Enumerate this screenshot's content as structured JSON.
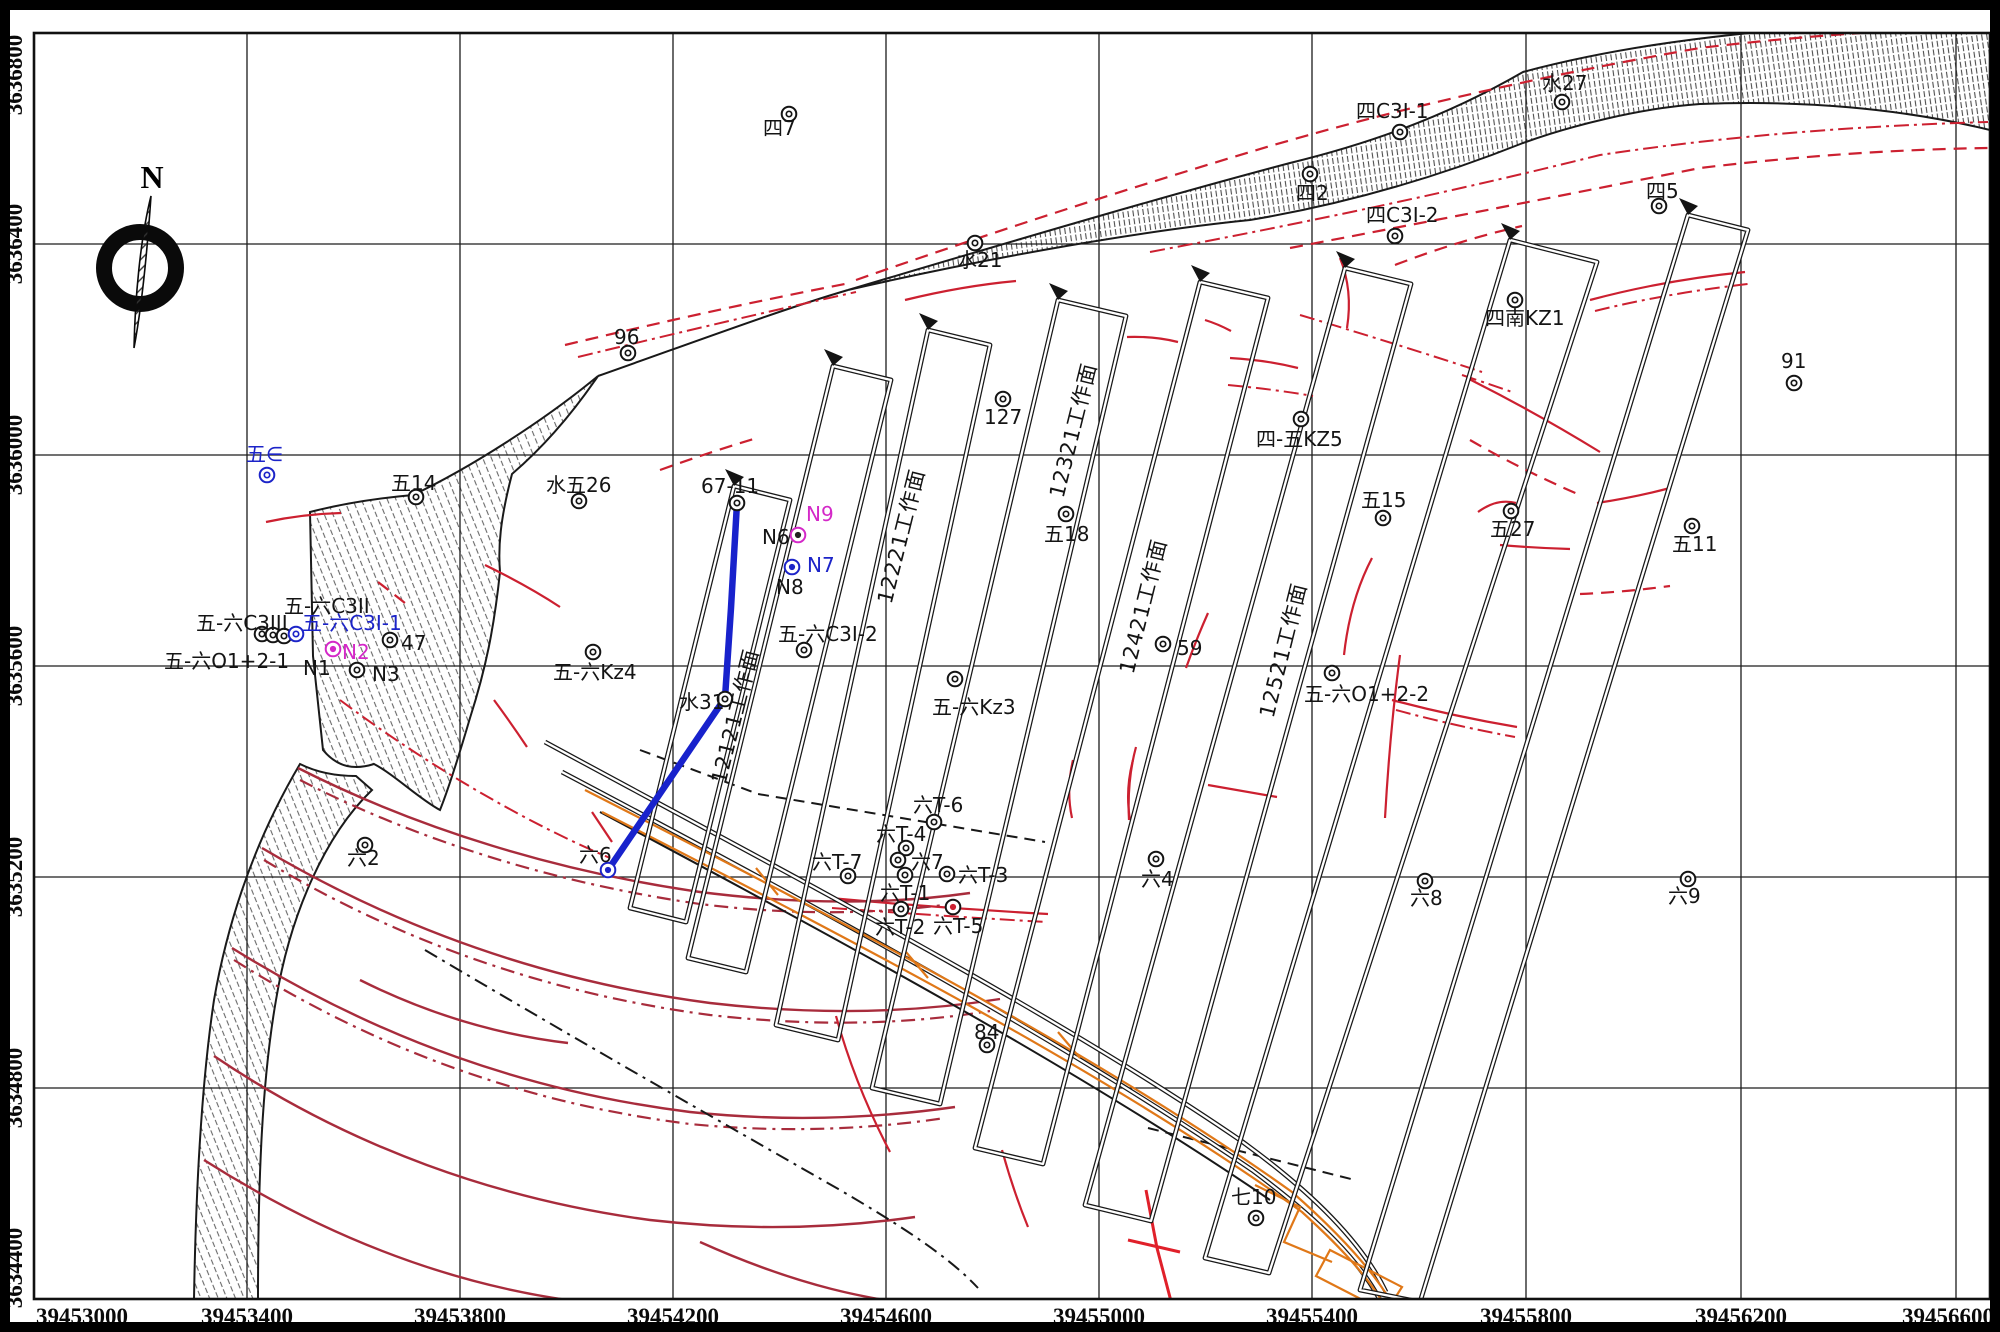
{
  "north_label": "N",
  "colors": {
    "black": "#141414",
    "blue": "#1c24c8",
    "magenta": "#d428c8",
    "red": "#cc2030",
    "darkred": "#a82c3c",
    "orange": "#e07818"
  },
  "axes": {
    "x": [
      {
        "label": "39453000",
        "px": 34,
        "lx": 36,
        "anchor": "start"
      },
      {
        "label": "39453400",
        "px": 247,
        "lx": 247,
        "anchor": "middle"
      },
      {
        "label": "39453800",
        "px": 460,
        "lx": 460,
        "anchor": "middle"
      },
      {
        "label": "39454200",
        "px": 673,
        "lx": 673,
        "anchor": "middle"
      },
      {
        "label": "39454600",
        "px": 886,
        "lx": 886,
        "anchor": "middle"
      },
      {
        "label": "39455000",
        "px": 1099,
        "lx": 1099,
        "anchor": "middle"
      },
      {
        "label": "39455400",
        "px": 1312,
        "lx": 1312,
        "anchor": "middle"
      },
      {
        "label": "39455800",
        "px": 1526,
        "lx": 1526,
        "anchor": "middle"
      },
      {
        "label": "39456200",
        "px": 1741,
        "lx": 1741,
        "anchor": "middle"
      },
      {
        "label": "39456600",
        "px": 1956,
        "lx": 1994,
        "anchor": "end"
      }
    ],
    "y": [
      {
        "label": "3636800",
        "px": 33,
        "ly": 75
      },
      {
        "label": "3636400",
        "px": 244,
        "ly": 244
      },
      {
        "label": "3636000",
        "px": 455,
        "ly": 455
      },
      {
        "label": "3635600",
        "px": 666,
        "ly": 666
      },
      {
        "label": "3635200",
        "px": 877,
        "ly": 877
      },
      {
        "label": "3634800",
        "px": 1088,
        "ly": 1088
      },
      {
        "label": "3634400",
        "px": 1299,
        "ly": 1268
      }
    ]
  },
  "work_faces": [
    {
      "l": "12121工作面",
      "x": 742,
      "y": 718
    },
    {
      "l": "12221工作面",
      "x": 908,
      "y": 538
    },
    {
      "l": "12321工作面",
      "x": 1080,
      "y": 432
    },
    {
      "l": "12421工作面",
      "x": 1150,
      "y": 608
    },
    {
      "l": "12521工作面",
      "x": 1290,
      "y": 652
    }
  ],
  "points": [
    {
      "l": "四7",
      "lx": 763,
      "ly": 135,
      "cx": 789,
      "cy": 114,
      "t": "k"
    },
    {
      "l": "水21",
      "lx": 957,
      "ly": 267,
      "cx": 975,
      "cy": 243,
      "t": "k"
    },
    {
      "l": "96",
      "lx": 614,
      "ly": 344,
      "cx": 628,
      "cy": 353,
      "t": "k"
    },
    {
      "l": "127",
      "lx": 984,
      "ly": 424,
      "cx": 1003,
      "cy": 399,
      "t": "k"
    },
    {
      "l": "水27",
      "lx": 1542,
      "ly": 90,
      "cx": 1562,
      "cy": 102,
      "t": "k"
    },
    {
      "l": "四C3I-1",
      "lx": 1356,
      "ly": 118,
      "cx": 1400,
      "cy": 132,
      "t": "k"
    },
    {
      "l": "四2",
      "lx": 1296,
      "ly": 200,
      "cx": 1310,
      "cy": 174,
      "t": "k"
    },
    {
      "l": "四C3I-2",
      "lx": 1366,
      "ly": 222,
      "cx": 1395,
      "cy": 236,
      "t": "k"
    },
    {
      "l": "四5",
      "lx": 1646,
      "ly": 198,
      "cx": 1659,
      "cy": 206,
      "t": "k"
    },
    {
      "l": "四南KZ1",
      "lx": 1485,
      "ly": 325,
      "cx": 1515,
      "cy": 300,
      "t": "k"
    },
    {
      "l": "91",
      "lx": 1781,
      "ly": 368,
      "cx": 1794,
      "cy": 383,
      "t": "k"
    },
    {
      "l": "四-五KZ5",
      "lx": 1256,
      "ly": 446,
      "cx": 1301,
      "cy": 419,
      "t": "k"
    },
    {
      "l": "五∈",
      "lx": 246,
      "ly": 461,
      "cx": 267,
      "cy": 475,
      "t": "b",
      "c": "b"
    },
    {
      "l": "五14",
      "lx": 391,
      "ly": 490,
      "cx": 416,
      "cy": 497,
      "t": "k"
    },
    {
      "l": "水五26",
      "lx": 546,
      "ly": 492,
      "cx": 579,
      "cy": 501,
      "t": "k"
    },
    {
      "l": "67-11",
      "lx": 701,
      "ly": 493,
      "cx": 737,
      "cy": 503,
      "t": "k"
    },
    {
      "l": "五15",
      "lx": 1361,
      "ly": 507,
      "cx": 1383,
      "cy": 518,
      "t": "k"
    },
    {
      "l": "五27",
      "lx": 1490,
      "ly": 536,
      "cx": 1511,
      "cy": 511,
      "t": "k"
    },
    {
      "l": "五11",
      "lx": 1672,
      "ly": 551,
      "cx": 1692,
      "cy": 526,
      "t": "k"
    },
    {
      "l": "五18",
      "lx": 1044,
      "ly": 541,
      "cx": 1066,
      "cy": 514,
      "t": "k"
    },
    {
      "l": "N9",
      "lx": 806,
      "ly": 521,
      "c": "m"
    },
    {
      "l": "N6",
      "lx": 762,
      "ly": 544,
      "cx": 798,
      "cy": 535,
      "t": "m"
    },
    {
      "l": "N7",
      "lx": 807,
      "ly": 572,
      "cx": 792,
      "cy": 567,
      "t": "bf",
      "c": "b"
    },
    {
      "l": "N8",
      "lx": 776,
      "ly": 594
    },
    {
      "l": "五-六C3I-2",
      "lx": 778,
      "ly": 641,
      "cx": 804,
      "cy": 650,
      "t": "k"
    },
    {
      "l": "五-六C3II",
      "lx": 284,
      "ly": 613
    },
    {
      "l": "五-六C3III",
      "lx": 196,
      "ly": 630
    },
    {
      "l": "五-六C3I-1",
      "lx": 302,
      "ly": 630,
      "c": "b"
    },
    {
      "l": "",
      "cx": 262,
      "cy": 634,
      "t": "k"
    },
    {
      "l": "",
      "cx": 273,
      "cy": 635,
      "t": "k"
    },
    {
      "l": "",
      "cx": 284,
      "cy": 636,
      "t": "k"
    },
    {
      "l": "",
      "cx": 296,
      "cy": 634,
      "t": "b"
    },
    {
      "l": "N2",
      "lx": 342,
      "ly": 659,
      "cx": 333,
      "cy": 649,
      "t": "mf",
      "c": "m"
    },
    {
      "l": "47",
      "lx": 401,
      "ly": 650,
      "cx": 390,
      "cy": 640,
      "t": "k"
    },
    {
      "l": "N1",
      "lx": 303,
      "ly": 675
    },
    {
      "l": "N3",
      "lx": 372,
      "ly": 681,
      "cx": 357,
      "cy": 670,
      "t": "k"
    },
    {
      "l": "五-六O1+2-1",
      "lx": 164,
      "ly": 668
    },
    {
      "l": "五-六Kz4",
      "lx": 553,
      "ly": 679,
      "cx": 593,
      "cy": 652,
      "t": "k"
    },
    {
      "l": "五-六Kz3",
      "lx": 932,
      "ly": 714,
      "cx": 955,
      "cy": 679,
      "t": "k"
    },
    {
      "l": "59",
      "lx": 1177,
      "ly": 655,
      "cx": 1163,
      "cy": 644,
      "t": "k"
    },
    {
      "l": "五-六O1+2-2",
      "lx": 1304,
      "ly": 701,
      "cx": 1332,
      "cy": 673,
      "t": "k"
    },
    {
      "l": "水31",
      "lx": 679,
      "ly": 709,
      "cx": 725,
      "cy": 699,
      "t": "k"
    },
    {
      "l": "六2",
      "lx": 347,
      "ly": 865,
      "cx": 365,
      "cy": 845,
      "t": "k"
    },
    {
      "l": "六T-6",
      "lx": 913,
      "ly": 812,
      "cx": 934,
      "cy": 822,
      "t": "k"
    },
    {
      "l": "六T-4",
      "lx": 876,
      "ly": 841,
      "cx": 906,
      "cy": 848,
      "t": "k"
    },
    {
      "l": "",
      "cx": 898,
      "cy": 860,
      "t": "k"
    },
    {
      "l": "六7",
      "lx": 911,
      "ly": 869,
      "cx": 905,
      "cy": 875,
      "t": "k"
    },
    {
      "l": "六T-3",
      "lx": 958,
      "ly": 882,
      "cx": 947,
      "cy": 874,
      "t": "k"
    },
    {
      "l": "六T-1",
      "lx": 880,
      "ly": 900
    },
    {
      "l": "六T-2",
      "lx": 875,
      "ly": 934,
      "cx": 901,
      "cy": 909,
      "t": "k"
    },
    {
      "l": "六T-5",
      "lx": 933,
      "ly": 933,
      "cx": 953,
      "cy": 907,
      "t": "rf"
    },
    {
      "l": "六T-7",
      "lx": 812,
      "ly": 869,
      "cx": 848,
      "cy": 876,
      "t": "k"
    },
    {
      "l": "六6",
      "lx": 579,
      "ly": 862,
      "cx": 608,
      "cy": 870,
      "t": "bf"
    },
    {
      "l": "六4",
      "lx": 1141,
      "ly": 886,
      "cx": 1156,
      "cy": 859,
      "t": "k"
    },
    {
      "l": "六8",
      "lx": 1410,
      "ly": 905,
      "cx": 1425,
      "cy": 881,
      "t": "k"
    },
    {
      "l": "六9",
      "lx": 1668,
      "ly": 903,
      "cx": 1688,
      "cy": 879,
      "t": "k"
    },
    {
      "l": "84",
      "lx": 974,
      "ly": 1039,
      "cx": 987,
      "cy": 1045,
      "t": "k"
    },
    {
      "l": "七10",
      "lx": 1231,
      "ly": 1204,
      "cx": 1256,
      "cy": 1218,
      "t": "k"
    }
  ]
}
